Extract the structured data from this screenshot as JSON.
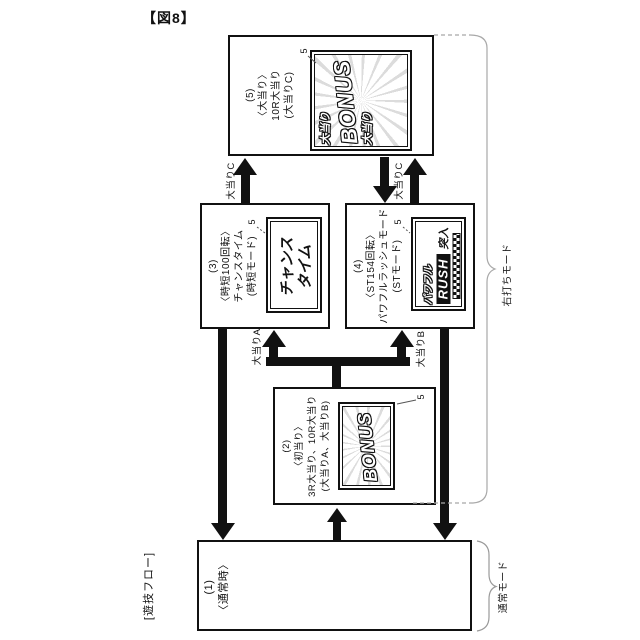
{
  "figure": {
    "title": "【図8】",
    "flow_label": "[遊技フロー]",
    "screen_ref": "5"
  },
  "boxes": {
    "b1": {
      "lines": [
        "(1)",
        "〈通常時〉"
      ]
    },
    "b2": {
      "lines": [
        "(2)",
        "〈初当り〉",
        "3R大当り、10R大当り",
        "(大当りA、大当りB)"
      ],
      "screen": {
        "bonus": "BONUS"
      }
    },
    "b3": {
      "lines": [
        "(3)",
        "〈時短100回転〉",
        "チャンスタイム",
        "(時短モード)"
      ],
      "screen": {
        "line1": "チャンス",
        "line2": "タイム"
      }
    },
    "b4": {
      "lines": [
        "(4)",
        "〈ST154回転〉",
        "パワフルラッシュモード",
        "(STモード)"
      ],
      "screen": {
        "line1": "パワフル",
        "line2": "RUSH",
        "line3": "突入"
      }
    },
    "b5": {
      "lines": [
        "(5)",
        "〈大当り〉",
        "10R大当り",
        "(大当りC)"
      ],
      "screen": {
        "jackpot": "大当り",
        "bonus": "BONUS"
      }
    }
  },
  "arrow_labels": {
    "c_left": "大当りC",
    "c_right": "大当りC",
    "a": "大当りA",
    "b": "大当りB"
  },
  "mode_labels": {
    "right_hit": "右打ちモード",
    "normal": "通常モード"
  },
  "colors": {
    "line": "#111111",
    "brace": "#a8a8a8",
    "burst_ray": "#dcdcdc"
  }
}
